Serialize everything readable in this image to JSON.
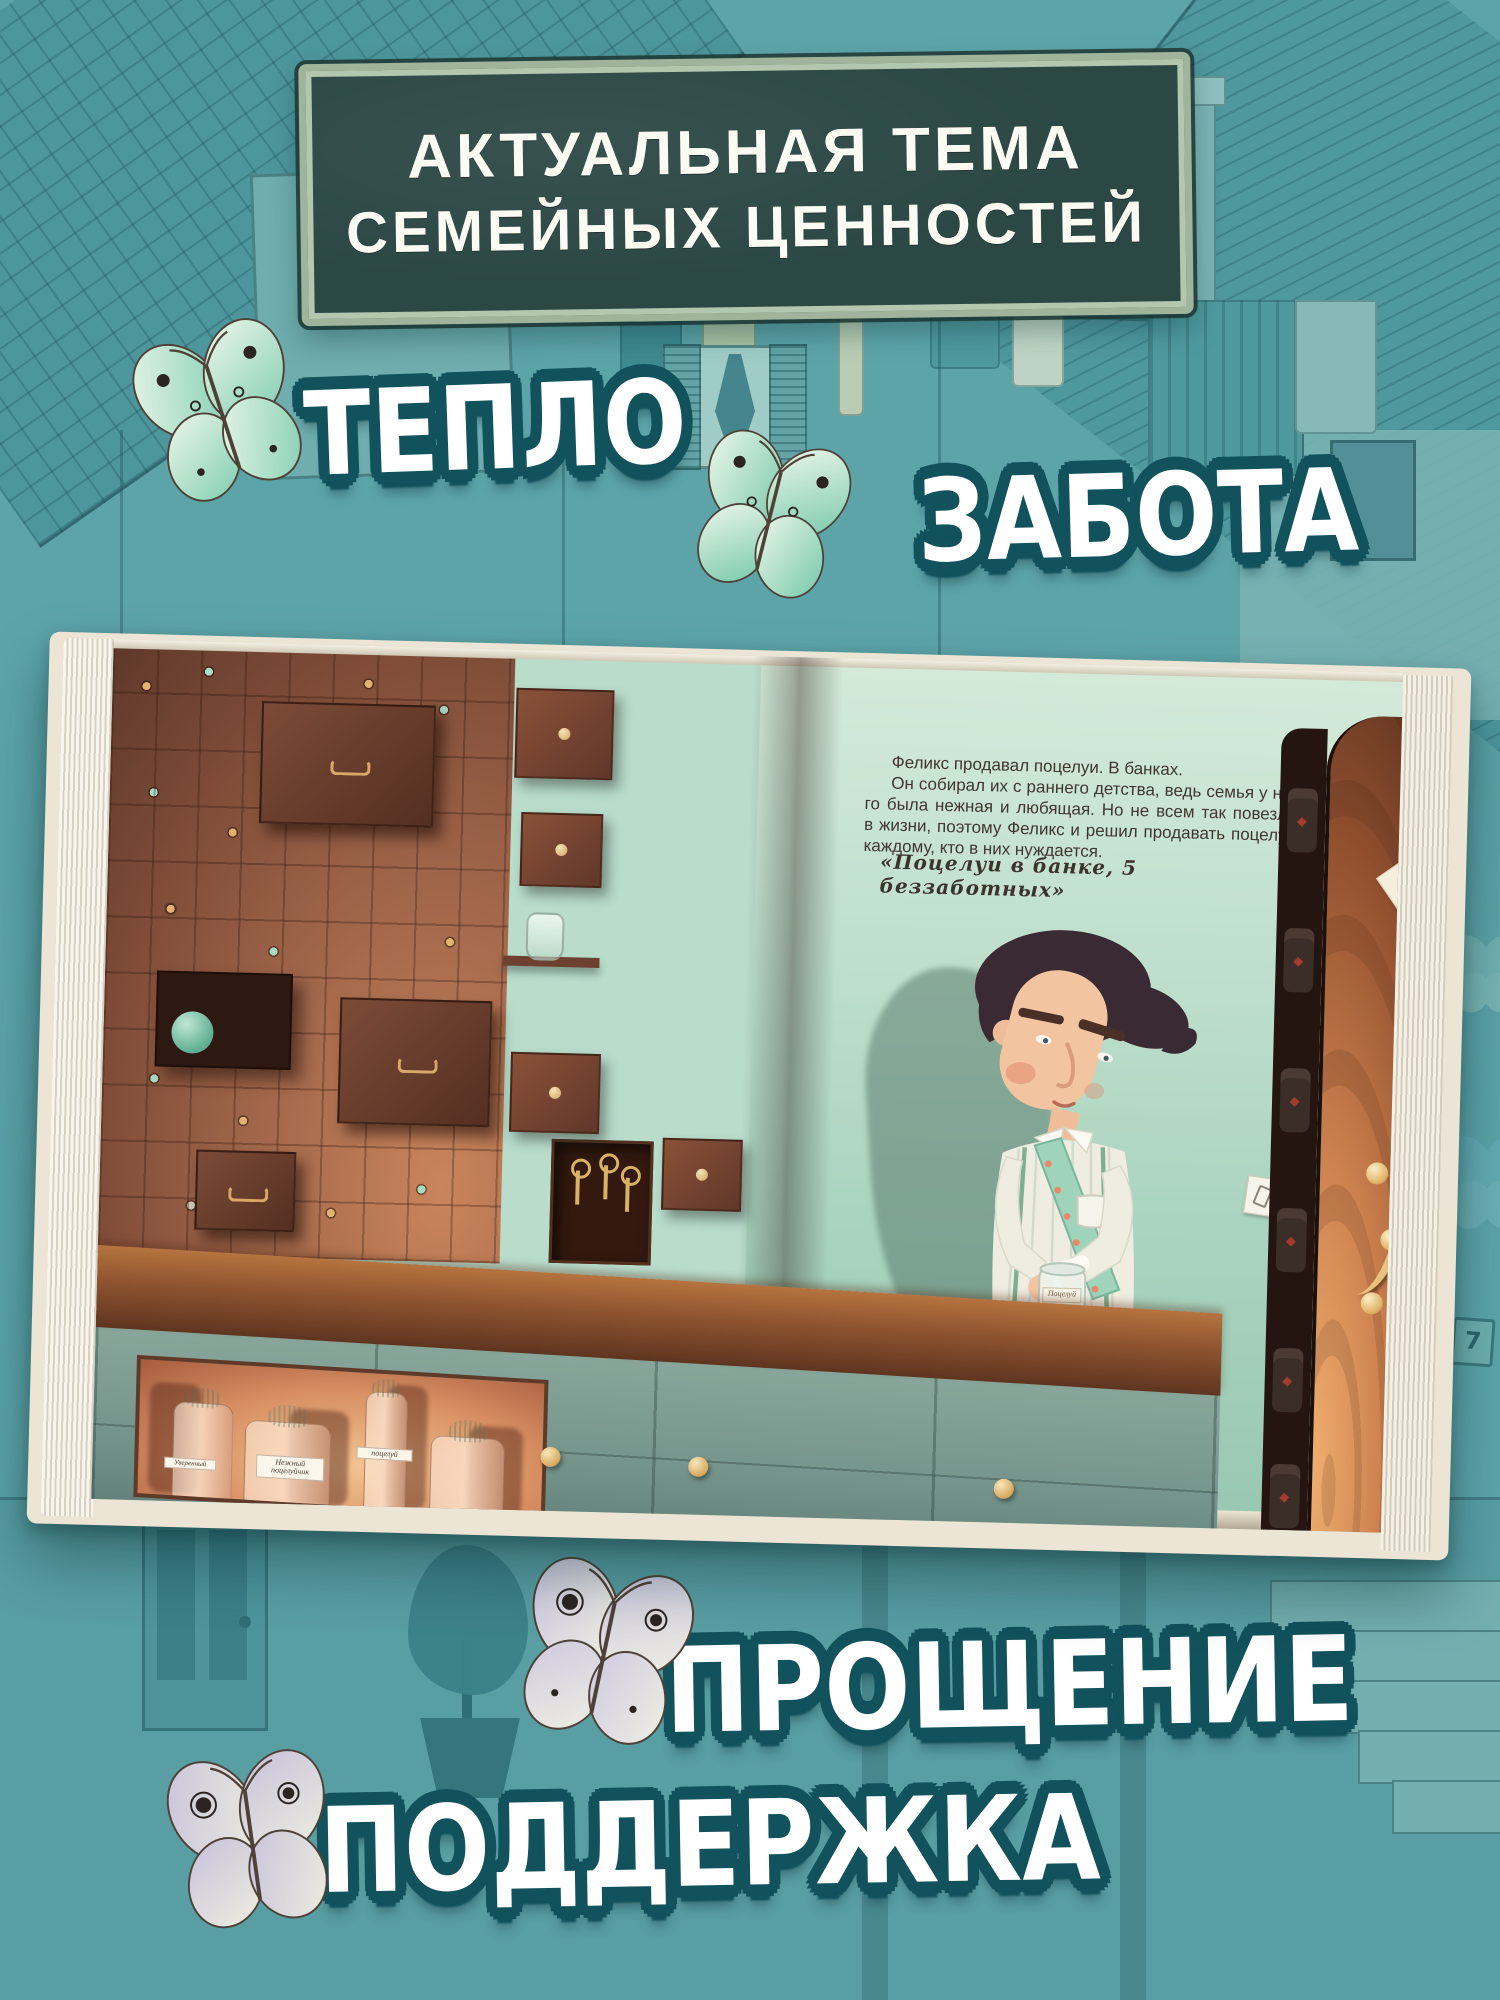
{
  "colors": {
    "background_teal": "#5da4a8",
    "sticker_outline": "#11525c",
    "board_surface": "#2c4845",
    "board_frame": "#b3c6ae",
    "page_mint": "#b9dccb",
    "wall_brown": "#8a5644",
    "door_glow": "#efae6e",
    "butterfly_mint": "#9fd8bd",
    "butterfly_lavender": "#c8c3dc"
  },
  "banner": {
    "line1": "АКТУАЛЬНАЯ ТЕМА",
    "line2": "СЕМЕЙНЫХ ЦЕННОСТЕЙ"
  },
  "keywords": [
    {
      "label": "ТЕПЛО"
    },
    {
      "label": "ЗАБОТА"
    },
    {
      "label": "ПРОЩЕНИЕ"
    },
    {
      "label": "ПОДДЕРЖКА"
    }
  ],
  "book": {
    "story_lines": [
      "Феликс продавал поцелуи. В банках.",
      "Он собирал их с раннего детства, ведь семья у не-",
      "го была нежная и любящая. Но не всем так повезло",
      "в жизни, поэтому Феликс и решил продавать поцелуи",
      "каждому, кто в них нуждается."
    ],
    "quote": "«Поцелуи в банке, 5 беззаботных»",
    "door_tag": "Запасные поц",
    "jar_label": "Поцелуй",
    "bottle_labels": [
      "Уверенный",
      "Нежный поцелуйчик",
      "поцелуй"
    ]
  },
  "background": {
    "house_number": "7"
  }
}
